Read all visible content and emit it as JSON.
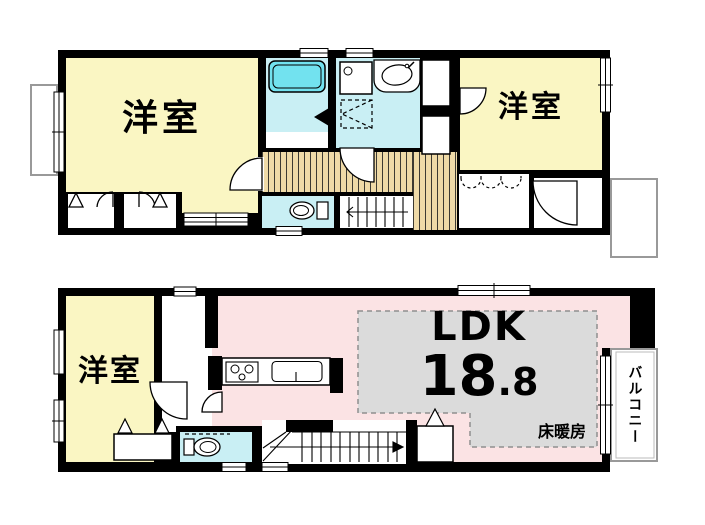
{
  "floor2": {
    "room_left_label": "洋室",
    "room_right_label": "洋室"
  },
  "floor1": {
    "room_label": "洋室",
    "ldk_label": "LDK",
    "ldk_size_int": "18",
    "ldk_size_frac": ".8",
    "floor_heating_label": "床暖房",
    "balcony_label": "バルコニー"
  },
  "colors": {
    "wall": "#000000",
    "room_yellow": "#FAF6C3",
    "wet_cyan": "#C9EFF4",
    "tub_cyan": "#72E2EF",
    "ldk_pink": "#FBE3E4",
    "heat_gray": "#DBDBDB",
    "heat_border": "#8F8F8F",
    "wood": "#EFDAA7",
    "eaves_border": "#999999"
  }
}
